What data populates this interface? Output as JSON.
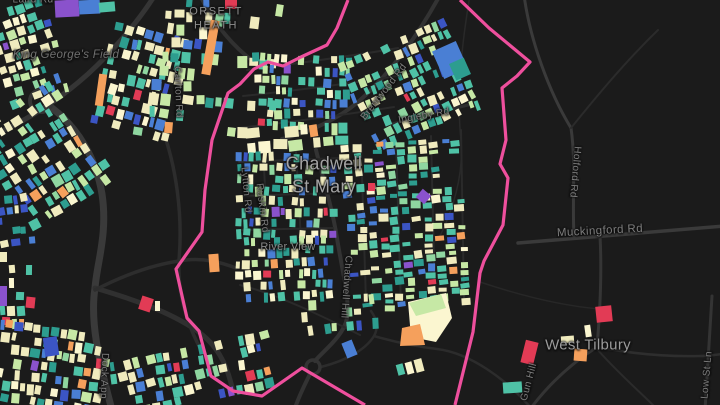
{
  "map": {
    "background": "#1b1b1b",
    "boundary_color": "#ee4f9d",
    "colors": {
      "cream": "#f0ebbe",
      "paleYellow": "#fbf6d0",
      "lightGreen": "#c6e8a5",
      "green": "#8fd6a0",
      "teal": "#4fc2a6",
      "deepTeal": "#2d9d8f",
      "blue": "#4a7fd4",
      "navy": "#3b55c4",
      "orange": "#f5a05c",
      "red": "#e23b55",
      "purple": "#8a52cc"
    },
    "palettes": {
      "default": {
        "cream": 26,
        "paleYellow": 12,
        "lightGreen": 13,
        "green": 5,
        "teal": 19,
        "deepTeal": 8,
        "blue": 8,
        "navy": 4,
        "orange": 3.5,
        "red": 0.9,
        "purple": 0.7
      },
      "central": {
        "cream": 20,
        "paleYellow": 7,
        "lightGreen": 15,
        "green": 7,
        "teal": 25,
        "deepTeal": 10,
        "blue": 9,
        "navy": 4,
        "orange": 1.5,
        "red": 0.6,
        "purple": 0.9
      },
      "navyHeavy": {
        "navy": 32,
        "blue": 28,
        "deepTeal": 12,
        "teal": 14,
        "cream": 9,
        "purple": 3,
        "lightGreen": 2
      },
      "creamArc": {
        "cream": 42,
        "paleYellow": 24,
        "orange": 12,
        "lightGreen": 9,
        "teal": 9,
        "red": 2,
        "blue": 2
      }
    },
    "place_labels": [
      {
        "id": "orsett-heath",
        "lines": [
          "ORSETT",
          "HEATH"
        ],
        "x": 216,
        "y": 19,
        "size": 11,
        "color": "#8f8f8f",
        "spacing": 1.5,
        "italic": false
      },
      {
        "id": "chadwell-st-mary",
        "lines": [
          "Chadwell",
          "St Mary"
        ],
        "x": 324,
        "y": 175,
        "size": 18,
        "color": "#a3a3a3",
        "spacing": 0.3,
        "italic": false
      },
      {
        "id": "west-tilbury",
        "lines": [
          "West Tilbury"
        ],
        "x": 588,
        "y": 346,
        "size": 15,
        "color": "#9b9b9b",
        "spacing": 0.3,
        "italic": false
      },
      {
        "id": "king-georges-field",
        "lines": [
          "King George's Field"
        ],
        "x": 66,
        "y": 55,
        "size": 11.5,
        "color": "#707070",
        "spacing": 0.3,
        "italic": true
      },
      {
        "id": "river-view",
        "lines": [
          "River View"
        ],
        "x": 288,
        "y": 248,
        "size": 11,
        "color": "#8a8a8a",
        "spacing": 0.3,
        "italic": false
      }
    ],
    "road_labels": [
      {
        "id": "laird-rd",
        "text": "Laird Rd",
        "x": 33,
        "y": 0,
        "rot": 0
      },
      {
        "id": "carlton-rd",
        "text": "Carlton Rd",
        "x": 178,
        "y": 92,
        "rot": 88
      },
      {
        "id": "lytton-rd",
        "text": "Lytton Rd",
        "x": 246,
        "y": 190,
        "rot": 85
      },
      {
        "id": "ruskin-rd",
        "text": "Ruskin Rd",
        "x": 262,
        "y": 208,
        "rot": 83
      },
      {
        "id": "brentwood-rd",
        "text": "Brentwood Rd",
        "x": 384,
        "y": 92,
        "rot": -52
      },
      {
        "id": "ingleby-rd",
        "text": "Ingleby Rd",
        "x": 424,
        "y": 116,
        "rot": -10
      },
      {
        "id": "chadwell-hill",
        "text": "Chadwell Hill",
        "x": 346,
        "y": 287,
        "rot": 94
      },
      {
        "id": "holford-rd",
        "text": "Holford Rd",
        "x": 575,
        "y": 172,
        "rot": 95
      },
      {
        "id": "dock-app",
        "text": "Dock App",
        "x": 104,
        "y": 376,
        "rot": 92
      },
      {
        "id": "gun-hill",
        "text": "Gun Hill",
        "x": 529,
        "y": 382,
        "rot": -75
      },
      {
        "id": "low-st-ln",
        "text": "Low St Ln",
        "x": 707,
        "y": 375,
        "rot": -85
      },
      {
        "id": "muckingford-rd",
        "text": "Muckingford Rd",
        "x": 600,
        "y": 231,
        "rot": -3,
        "size": 11.5
      }
    ],
    "roads": [
      {
        "d": "M155,-5 C138,22 112,52 88,74 C60,99 28,120 -5,134",
        "w": 5,
        "c": "#353535"
      },
      {
        "d": "M52,108 C78,128 96,158 102,194 C108,234 97,262 95,288 C90,320 98,358 112,410",
        "w": 7,
        "c": "#3a3a3a"
      },
      {
        "d": "M95,288 C132,299 168,311 196,330 C216,344 227,362 233,392",
        "w": 5,
        "c": "#303030"
      },
      {
        "d": "M95,290 C122,276 152,264 186,260 C204,258 220,262 236,268",
        "w": 3.5,
        "c": "#2d2d2d"
      },
      {
        "d": "M162,128 C176,166 183,214 179,260 C177,296 188,332 214,372",
        "w": 3.5,
        "c": "#2d2d2d"
      },
      {
        "d": "M200,-5 C212,20 230,44 254,62",
        "w": 4,
        "c": "#313131"
      },
      {
        "d": "M440,-5 C420,32 392,72 358,102 C338,119 310,132 282,139",
        "w": 4,
        "c": "#333333"
      },
      {
        "d": "M392,124 C418,117 444,111 468,105",
        "w": 3,
        "c": "#2e2e2e"
      },
      {
        "d": "M316,150 C324,182 333,212 337,238 C342,270 350,300 347,318 C344,336 322,352 315,361",
        "w": 4,
        "c": "#333333"
      },
      {
        "d": "M310,374 C304,386 299,396 295,408",
        "w": 4,
        "c": "#333333"
      },
      {
        "d": "M321,367 C348,360 366,349 374,336 C379,327 376,318 371,311",
        "w": 2.5,
        "c": "#2c2c2c"
      },
      {
        "d": "M374,336 C398,343 420,347 437,349 C470,353 506,379 531,408",
        "w": 2.5,
        "c": "#2c2c2c"
      },
      {
        "d": "M524,-5 C530,40 549,92 571,128 C576,162 572,200 574,236",
        "w": 3,
        "c": "#3a3a3a"
      },
      {
        "d": "M571,128 C596,97 625,62 658,30",
        "w": 2,
        "c": "#2b2b2b"
      },
      {
        "d": "M518,243 C576,238 650,232 725,226",
        "w": 3.5,
        "c": "#3a3a3a"
      },
      {
        "d": "M600,236 C602,272 600,312 597,347",
        "w": 3,
        "c": "#353535"
      },
      {
        "d": "M597,347 C572,363 549,384 531,408",
        "w": 3,
        "c": "#343434"
      },
      {
        "d": "M597,347 C628,353 664,357 700,356 C707,356 714,355 722,354",
        "w": 2.5,
        "c": "#2e2e2e"
      },
      {
        "d": "M712,296 C710,330 708,365 705,410",
        "w": 3,
        "c": "#343434"
      },
      {
        "d": "M597,349 C615,370 640,392 656,408",
        "w": 2,
        "c": "#2b2b2b"
      },
      {
        "d": "M470,-5 C462,42 456,95 461,140 C464,176 452,212 440,236",
        "w": 1.5,
        "c": "#292929"
      },
      {
        "d": "M480,282 C522,296 562,306 600,309",
        "w": 1.5,
        "c": "#272727"
      },
      {
        "d": "M247,70 C300,63 352,56 398,48",
        "w": 2,
        "c": "#2a2a2a"
      },
      {
        "d": "M243,96 C300,90 362,82 422,72",
        "w": 2,
        "c": "#2a2a2a"
      },
      {
        "d": "M237,128 C292,122 342,115 394,107",
        "w": 2,
        "c": "#2a2a2a"
      },
      {
        "d": "M239,162 L341,158",
        "w": 2,
        "c": "#2a2a2a"
      },
      {
        "d": "M237,196 L336,193",
        "w": 2,
        "c": "#2a2a2a"
      },
      {
        "d": "M239,230 L333,228",
        "w": 2,
        "c": "#2a2a2a"
      },
      {
        "d": "M263,152 L268,236",
        "w": 2,
        "c": "#2a2a2a"
      },
      {
        "d": "M296,152 L301,240",
        "w": 2,
        "c": "#2a2a2a"
      },
      {
        "d": "M361,144 L366,302",
        "w": 2,
        "c": "#2a2a2a"
      },
      {
        "d": "M396,140 L401,306",
        "w": 2,
        "c": "#2a2a2a"
      },
      {
        "d": "M431,136 L435,302",
        "w": 2,
        "c": "#2a2a2a"
      },
      {
        "d": "M461,130 L464,298",
        "w": 2,
        "c": "#2a2a2a"
      },
      {
        "d": "M240,285 C280,295 330,320 360,335",
        "w": 2,
        "c": "#2a2a2a"
      }
    ],
    "roundabouts": [
      {
        "cx": 41,
        "cy": 101,
        "r": 11,
        "w": 4,
        "c": "#353535"
      },
      {
        "cx": 313,
        "cy": 367,
        "r": 7,
        "w": 3.5,
        "c": "#333333"
      }
    ],
    "boundary": {
      "left": [
        [
          348,
          0
        ],
        [
          337,
          28
        ],
        [
          327,
          45
        ],
        [
          301,
          57
        ],
        [
          283,
          66
        ],
        [
          268,
          62
        ],
        [
          254,
          69
        ],
        [
          240,
          84
        ],
        [
          228,
          93
        ],
        [
          212,
          140
        ],
        [
          205,
          190
        ],
        [
          202,
          232
        ],
        [
          176,
          269
        ],
        [
          187,
          318
        ],
        [
          199,
          331
        ],
        [
          211,
          376
        ],
        [
          233,
          391
        ],
        [
          262,
          396
        ],
        [
          302,
          368
        ],
        [
          365,
          405
        ]
      ],
      "right": [
        [
          460,
          0
        ],
        [
          489,
          28
        ],
        [
          530,
          62
        ],
        [
          517,
          76
        ],
        [
          502,
          88
        ],
        [
          506,
          140
        ],
        [
          500,
          164
        ],
        [
          508,
          178
        ],
        [
          503,
          225
        ],
        [
          484,
          261
        ],
        [
          480,
          273
        ],
        [
          473,
          332
        ],
        [
          455,
          405
        ]
      ]
    },
    "clusters": [
      {
        "id": "topleft-upper",
        "x": -6,
        "y": 4,
        "w": 64,
        "h": 102,
        "angle": -18,
        "rowH": 9,
        "cellW": 6,
        "gap": 2,
        "skip": 0.3,
        "seed": 11,
        "palette": "default"
      },
      {
        "id": "topleft-lower",
        "x": -10,
        "y": 96,
        "w": 102,
        "h": 118,
        "angle": -33,
        "rowH": 10,
        "cellW": 6,
        "gap": 2,
        "skip": 0.3,
        "seed": 22,
        "palette": "default"
      },
      {
        "id": "midtop",
        "x": 100,
        "y": 28,
        "w": 78,
        "h": 110,
        "angle": 14,
        "rowH": 10,
        "cellW": 6,
        "gap": 2,
        "skip": 0.36,
        "seed": 33,
        "palette": "default"
      },
      {
        "id": "leftedge-navy",
        "x": -4,
        "y": 194,
        "w": 34,
        "h": 50,
        "angle": -8,
        "rowH": 9,
        "cellW": 6,
        "gap": 2,
        "skip": 0.28,
        "seed": 44,
        "palette": "navyHeavy"
      },
      {
        "id": "leftedge-low",
        "x": -4,
        "y": 252,
        "w": 44,
        "h": 78,
        "angle": 0,
        "rowH": 10,
        "cellW": 6,
        "gap": 3,
        "skip": 0.55,
        "seed": 55,
        "palette": "default"
      },
      {
        "id": "bottomleft-a",
        "x": -6,
        "y": 326,
        "w": 114,
        "h": 84,
        "angle": 8,
        "rowH": 10,
        "cellW": 6,
        "gap": 2,
        "skip": 0.22,
        "seed": 66,
        "palette": "default"
      },
      {
        "id": "bottomleft-b",
        "x": 112,
        "y": 346,
        "w": 158,
        "h": 62,
        "angle": -12,
        "rowH": 10,
        "cellW": 6,
        "gap": 2,
        "skip": 0.42,
        "seed": 77,
        "palette": "central"
      },
      {
        "id": "orsett-heath",
        "x": 150,
        "y": -2,
        "w": 126,
        "h": 134,
        "angle": 4,
        "rowH": 11,
        "cellW": 7,
        "gap": 3,
        "skip": 0.56,
        "seed": 88,
        "palette": "default"
      },
      {
        "id": "central-nw",
        "x": 250,
        "y": 54,
        "w": 102,
        "h": 74,
        "angle": 2,
        "rowH": 9,
        "cellW": 5,
        "gap": 2,
        "skip": 0.33,
        "seed": 99,
        "palette": "central"
      },
      {
        "id": "central-ne",
        "x": 352,
        "y": 36,
        "w": 118,
        "h": 102,
        "angle": -24,
        "rowH": 9,
        "cellW": 5,
        "gap": 2,
        "skip": 0.3,
        "seed": 110,
        "palette": "central"
      },
      {
        "id": "cream-arc",
        "x": 246,
        "y": 124,
        "w": 98,
        "h": 28,
        "angle": -4,
        "rowH": 12,
        "cellW": 9,
        "gap": 2,
        "skip": 0.18,
        "seed": 121,
        "palette": "creamArc"
      },
      {
        "id": "central-w",
        "x": 234,
        "y": 152,
        "w": 102,
        "h": 84,
        "angle": 1,
        "rowH": 9,
        "cellW": 5,
        "gap": 2,
        "skip": 0.33,
        "seed": 132,
        "palette": "central"
      },
      {
        "id": "central-e",
        "x": 323,
        "y": 165,
        "w": 168,
        "h": 118,
        "angle": 86,
        "rowH": 9,
        "cellW": 5,
        "gap": 2,
        "skip": 0.36,
        "seed": 143,
        "palette": "central"
      },
      {
        "id": "central-sw",
        "x": 234,
        "y": 236,
        "w": 98,
        "h": 68,
        "angle": -2,
        "rowH": 9,
        "cellW": 5,
        "gap": 2,
        "skip": 0.38,
        "seed": 154,
        "palette": "central"
      },
      {
        "id": "central-s",
        "x": 298,
        "y": 294,
        "w": 112,
        "h": 32,
        "angle": -6,
        "rowH": 10,
        "cellW": 6,
        "gap": 3,
        "skip": 0.66,
        "seed": 165,
        "palette": "central"
      }
    ],
    "singles": [
      {
        "x": 55,
        "y": 0,
        "w": 24,
        "h": 17,
        "rot": -3,
        "color": "purple"
      },
      {
        "x": 79,
        "y": 0,
        "w": 21,
        "h": 14,
        "rot": -3,
        "color": "blue"
      },
      {
        "x": 99,
        "y": 2,
        "w": 16,
        "h": 10,
        "rot": -5,
        "color": "teal"
      },
      {
        "x": 225,
        "y": 0,
        "w": 12,
        "h": 9,
        "rot": 0,
        "color": "red"
      },
      {
        "x": 206,
        "y": 20,
        "w": 9,
        "h": 55,
        "rot": 10,
        "color": "orange"
      },
      {
        "x": 97,
        "y": 74,
        "w": 8,
        "h": 32,
        "rot": 8,
        "color": "orange"
      },
      {
        "x": 437,
        "y": 45,
        "w": 26,
        "h": 30,
        "rot": -24,
        "color": "blue"
      },
      {
        "x": 452,
        "y": 60,
        "w": 16,
        "h": 18,
        "rot": -24,
        "color": "deepTeal"
      },
      {
        "x": 209,
        "y": 254,
        "w": 10,
        "h": 18,
        "rot": -4,
        "color": "orange"
      },
      {
        "x": 140,
        "y": 297,
        "w": 12,
        "h": 14,
        "rot": 18,
        "color": "red"
      },
      {
        "x": 155,
        "y": 301,
        "w": 5,
        "h": 10,
        "rot": 0,
        "color": "paleYellow"
      },
      {
        "x": 0,
        "y": 286,
        "w": 7,
        "h": 20,
        "rot": 0,
        "color": "purple"
      },
      {
        "x": 26,
        "y": 297,
        "w": 9,
        "h": 11,
        "rot": 6,
        "color": "red"
      },
      {
        "x": 44,
        "y": 337,
        "w": 14,
        "h": 19,
        "rot": -8,
        "color": "navy"
      },
      {
        "x": 418,
        "y": 191,
        "w": 11,
        "h": 11,
        "rot": 40,
        "color": "purple"
      },
      {
        "x": 368,
        "y": 183,
        "w": 7,
        "h": 8,
        "rot": 0,
        "color": "red"
      },
      {
        "x": 344,
        "y": 341,
        "w": 11,
        "h": 16,
        "rot": -22,
        "color": "blue"
      },
      {
        "x": 397,
        "y": 364,
        "w": 7,
        "h": 11,
        "rot": -15,
        "color": "teal"
      },
      {
        "x": 406,
        "y": 362,
        "w": 7,
        "h": 12,
        "rot": -15,
        "color": "paleYellow"
      },
      {
        "x": 415,
        "y": 359,
        "w": 8,
        "h": 13,
        "rot": -15,
        "color": "cream"
      },
      {
        "x": 596,
        "y": 306,
        "w": 16,
        "h": 16,
        "rot": -6,
        "color": "red"
      },
      {
        "x": 523,
        "y": 341,
        "w": 13,
        "h": 23,
        "rot": 14,
        "color": "red"
      },
      {
        "x": 574,
        "y": 349,
        "w": 13,
        "h": 12,
        "rot": 4,
        "color": "orange"
      },
      {
        "x": 561,
        "y": 336,
        "w": 13,
        "h": 7,
        "rot": -4,
        "color": "cream"
      },
      {
        "x": 585,
        "y": 325,
        "w": 6,
        "h": 12,
        "rot": -8,
        "color": "paleYellow"
      },
      {
        "x": 503,
        "y": 382,
        "w": 19,
        "h": 11,
        "rot": -4,
        "color": "teal"
      }
    ],
    "school_polys": [
      {
        "points": "408,302 446,293 452,318 436,342 411,337",
        "color": "paleYellow"
      },
      {
        "points": "409,303 441,294 446,308 416,316",
        "color": "lightGreen"
      },
      {
        "points": "402,328 420,324 425,345 400,346",
        "color": "orange"
      }
    ]
  }
}
